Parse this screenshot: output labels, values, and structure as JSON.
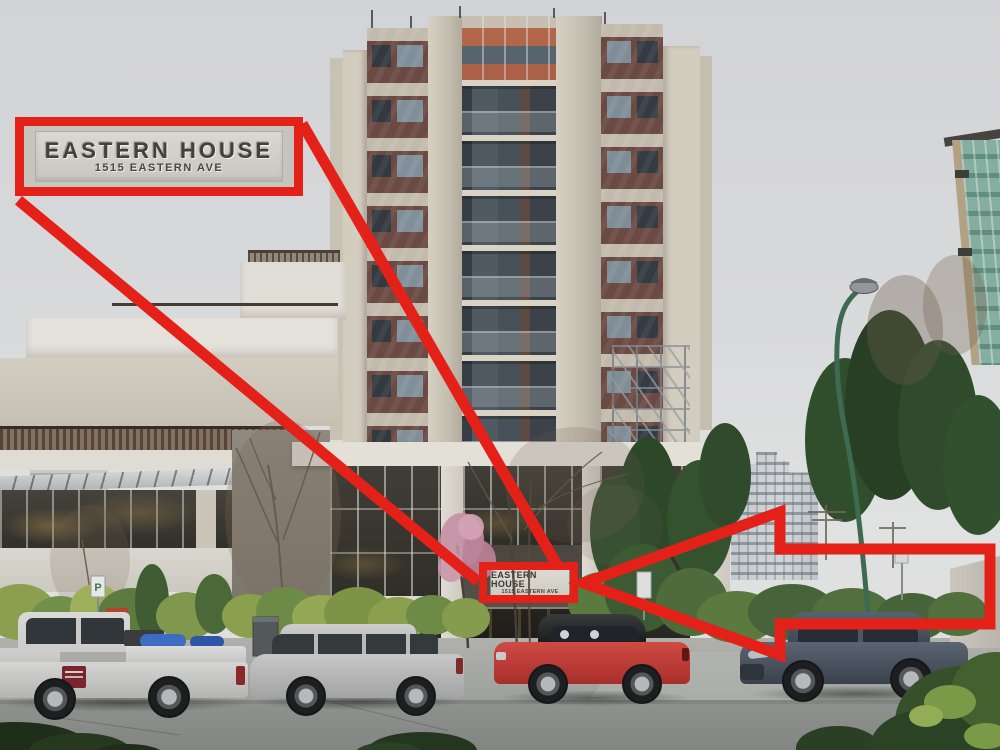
{
  "annotations": {
    "accent_color": "#e32119",
    "callout_box": {
      "title": "EASTERN HOUSE",
      "subtitle": "1515 EASTERN AVE"
    },
    "building_sign": {
      "title": "EASTERN HOUSE",
      "subtitle": "1515 EASTERN AVE"
    }
  },
  "street": {
    "parking_sign_label": "P"
  },
  "scene": {
    "palette": {
      "sky_top": "#d2d3d6",
      "sky_bottom": "#e0e1e1",
      "tower_concrete": "#cfc9bc",
      "tower_panel_maroon": "#6a4a43",
      "tower_accent_orange": "#b2674b",
      "podium_white": "#e4e1da",
      "hedge_green": "#5a7a40",
      "lamp_green": "#3d6b52",
      "road_gray": "#8f918f",
      "annotation_red": "#e32119"
    },
    "vehicles": [
      {
        "name": "pickup-truck",
        "color": "#d3d4d2"
      },
      {
        "name": "station-wagon",
        "color": "#bcbdbd"
      },
      {
        "name": "convertible",
        "color": "#c03c38"
      },
      {
        "name": "sedan",
        "color": "#49525e"
      }
    ]
  }
}
